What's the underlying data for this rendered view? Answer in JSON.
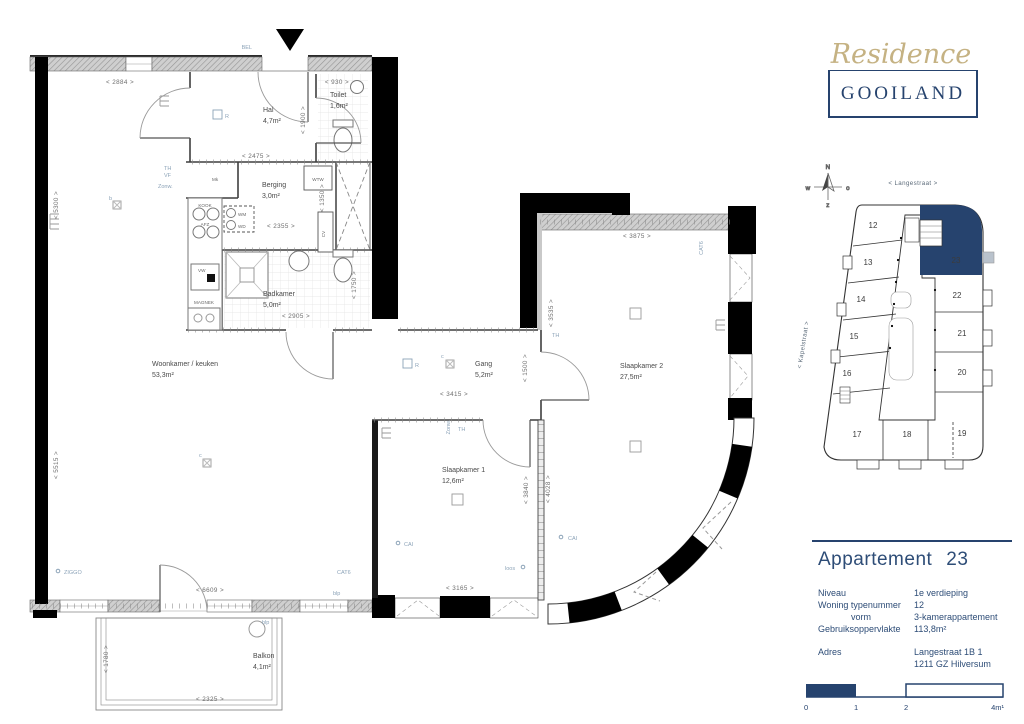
{
  "logo": {
    "script": "Residence",
    "name": "GOOILAND"
  },
  "plan": {
    "rooms": [
      {
        "name": "Woonkamer / keuken",
        "area": "53,3m²"
      },
      {
        "name": "Hal",
        "area": "4,7m²"
      },
      {
        "name": "Toilet",
        "area": "1,6m²"
      },
      {
        "name": "Berging",
        "area": "3,0m²"
      },
      {
        "name": "Badkamer",
        "area": "5,0m²"
      },
      {
        "name": "Gang",
        "area": "5,2m²"
      },
      {
        "name": "Slaapkamer 1",
        "area": "12,6m²"
      },
      {
        "name": "Slaapkamer 2",
        "area": "27,5m²"
      },
      {
        "name": "Balkon",
        "area": "4,1m²"
      }
    ],
    "dims": {
      "d2884": "< 2884 >",
      "d5300": "< 5300 >",
      "d5515": "< 5515 >",
      "d930": "< 930 >",
      "d1900": "< 1900 >",
      "d2475": "< 2475 >",
      "d2355": "< 2355 >",
      "d1350": "< 1350 >",
      "d2905": "< 2905 >",
      "d1750": "< 1750 >",
      "d3415": "< 3415 >",
      "d1500": "< 1500 >",
      "d3535": "< 3535 >",
      "d3875": "< 3875 >",
      "d3840": "< 3840 >",
      "d4028": "< 4028 >",
      "d6609": "< 6609 >",
      "d3165": "< 3165 >",
      "d1780": "< 1780 >",
      "d2325": "< 2325 >"
    },
    "tags": {
      "bel": "BEL",
      "th": "TH",
      "vf": "VF",
      "zonw": "Zonw.",
      "cat6": "CAT6",
      "cai": "CAI",
      "blp": "blp",
      "loos": "loos",
      "ziggo": "ZIGGO",
      "r": "R",
      "b": "b",
      "c": "c",
      "mk": "Mk",
      "wm": "WM",
      "wd": "WD",
      "wtw": "WTW",
      "cv": "CV",
      "kook": "KOOK",
      "afz": "AFZ",
      "vw": "VW",
      "magnek": "MAGNEK"
    }
  },
  "site_plan": {
    "street_top": "< Langestraat >",
    "street_left": "< Kapelstraat >",
    "compass": {
      "n": "N",
      "w": "w",
      "o": "o",
      "z": "z"
    },
    "units": {
      "u12": "12",
      "u13": "13",
      "u14": "14",
      "u15": "15",
      "u16": "16",
      "u17": "17",
      "u18": "18",
      "u19": "19",
      "u20": "20",
      "u21": "21",
      "u22": "22",
      "u23": "23"
    },
    "highlighted": "23"
  },
  "info": {
    "title": "Appartement",
    "number": "23",
    "rows": [
      {
        "label": "Niveau",
        "value": "1e verdieping"
      },
      {
        "label": "Woning typenummer",
        "value": "12"
      },
      {
        "label": "vorm",
        "value": "3-kamerappartement"
      },
      {
        "label": "Gebruiksoppervlakte",
        "value": "113,8m²"
      },
      {
        "label": "Adres",
        "value": "Langestraat 1B 1",
        "value2": "1211 GZ Hilversum"
      }
    ]
  },
  "scale": {
    "t0": "0",
    "t1": "1",
    "t2": "2",
    "t4": "4m¹"
  },
  "colors": {
    "navy": "#26436e",
    "gold": "#c5b283",
    "wall": "#000000",
    "window_gray": "#cfcfcf",
    "tag_blue": "#8ca3b8",
    "dim_gray": "#6e6e6e"
  }
}
